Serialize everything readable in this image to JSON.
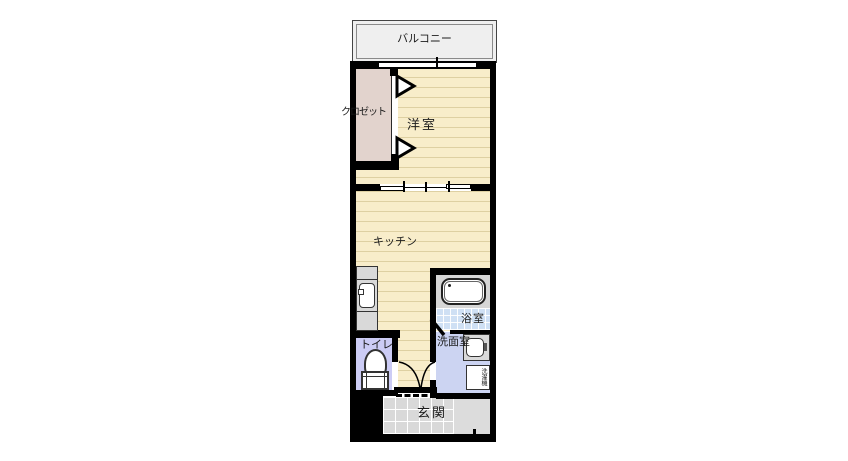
{
  "plan": {
    "balcony": "バルコニー",
    "closet": "クロゼット",
    "western_room": "洋室",
    "kitchen": "キッチン",
    "bathroom": "浴室",
    "washroom": "洗面室",
    "washer": "洗濯機",
    "toilet": "トイレ",
    "entrance": "玄関"
  },
  "colors": {
    "wall": "#000000",
    "wood_floor": "#f8edca",
    "wood_stripe": "#ded0a2",
    "closet_floor": "#e2d3cd",
    "balcony_floor": "#efefef",
    "bath_tile": "#cfe0f4",
    "washroom_floor": "#ccd4f2",
    "toilet_floor": "#ccccf5",
    "fixture_gray": "#d9d9d9",
    "genkan_tile": "#d9d9d9",
    "porch": "#dcdcdc"
  }
}
